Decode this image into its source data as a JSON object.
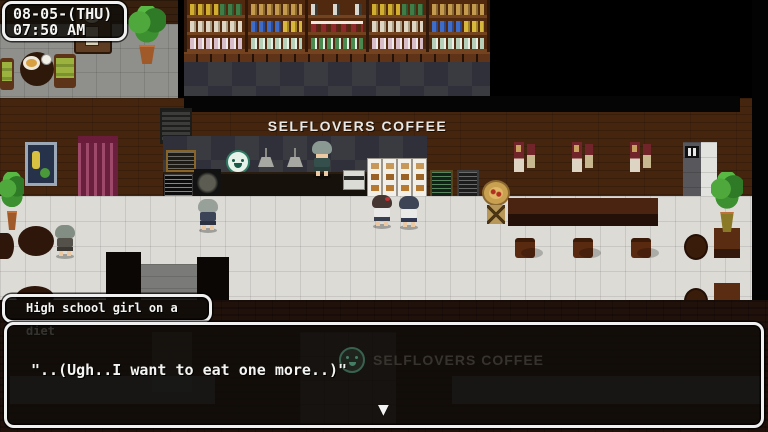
{
  "hud": {
    "datetime": {
      "date": "08-05-(THU)",
      "time": "07:50 AM"
    }
  },
  "scene": {
    "sign": "SELFLOVERS COFFEE",
    "characters": [
      "barista",
      "schoolgirl-customer-left",
      "schoolgirl-customer-right",
      "schoolgirl-at-menu-board",
      "high-school-girl-speaker"
    ],
    "icons": {
      "cafe_logo": "smiling-face-logo",
      "restroom_sign": "restroom-figures",
      "wall_clock": "grandfather-clock"
    }
  },
  "dialogue": {
    "speaker": "High school girl on a diet",
    "text": "\"..(Ugh..I want to eat one more..)\"",
    "watermark_text": "SELFLOVERS COFFEE",
    "continue_indicator": "▼"
  },
  "colors": {
    "ui_border": "#f0f0f0",
    "ui_background": "rgba(16,13,10,0.84)",
    "sign_text": "#e8e8e6",
    "watermark_text": "#3b3732",
    "logo_teal": "#2e7a62",
    "wall_brown": "#46250e",
    "floor_tile": "#dcdbd6",
    "checker_wall": "#3a3a41",
    "curtain_magenta": "#8e2950"
  }
}
